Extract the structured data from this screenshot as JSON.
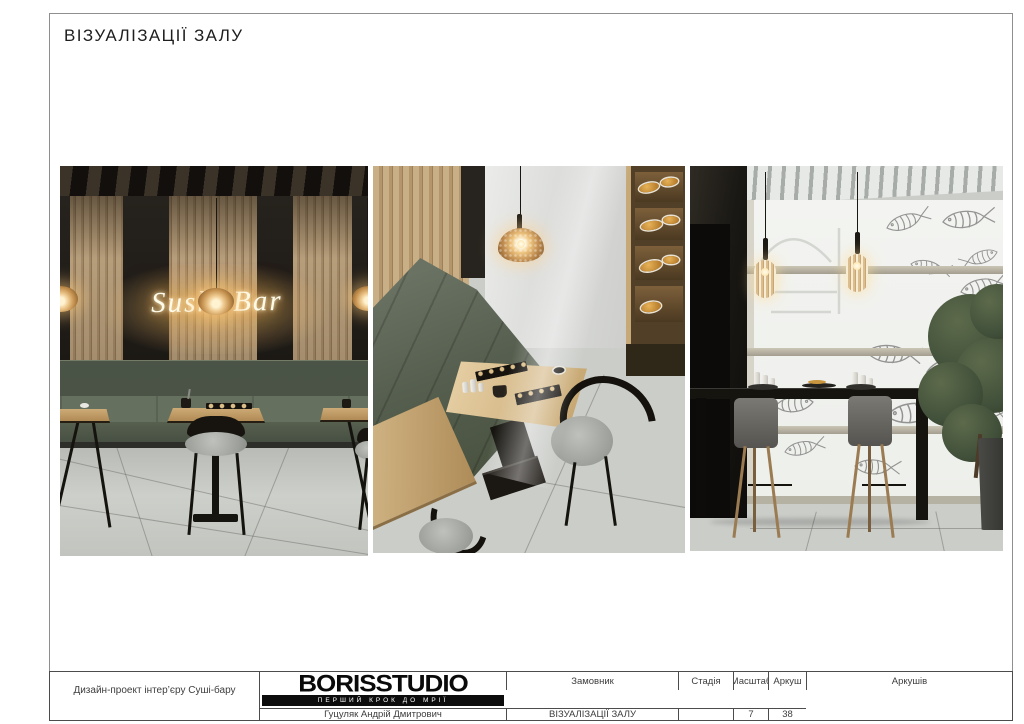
{
  "page": {
    "title": "ВІЗУАЛІЗАЦІЇ ЗАЛУ"
  },
  "neon_sign": {
    "text": "Sushi Bar"
  },
  "title_block": {
    "project": "Дизайн-проект інтер’єру Суші-бару",
    "client": {
      "label": "Замовник",
      "value": "Гуцуляк Андрій Дмитрович"
    },
    "stage": {
      "label": "Стадія",
      "value": "ВІЗУАЛІЗАЦІЇ ЗАЛУ"
    },
    "scale": {
      "label": "Масштаб",
      "value": ""
    },
    "sheet": {
      "label": "Аркуш",
      "value": "7"
    },
    "sheets": {
      "label": "Аркушів",
      "value": "38"
    }
  },
  "logo": {
    "name": "BORISSTUDIO",
    "tagline": "ПЕРШИЙ КРОК ДО МРІЇ"
  },
  "colors": {
    "wood": "#b49872",
    "banquette_green": "#5c6555",
    "neon_glow": "#ffd27a",
    "floor": "#cbcdc9",
    "logo_black": "#0c0c0c"
  }
}
